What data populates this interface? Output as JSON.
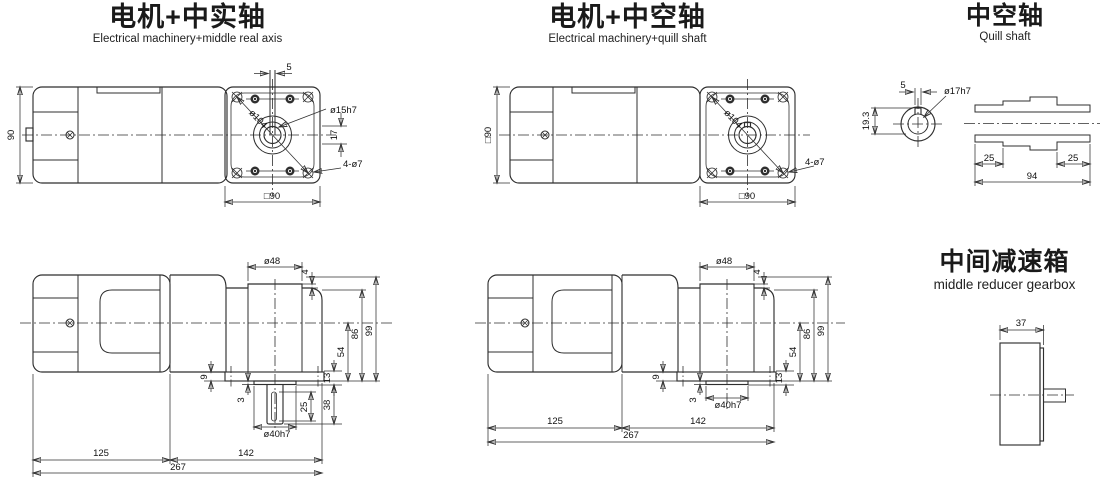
{
  "colors": {
    "line": "#2f2f2f",
    "text": "#111111",
    "background": "#ffffff"
  },
  "titles": {
    "solid": {
      "zh": "电机+中实轴",
      "en": "Electrical machinery+middle real axis"
    },
    "hollow": {
      "zh": "电机+中空轴",
      "en": "Electrical machinery+quill shaft"
    },
    "quill": {
      "zh": "中空轴",
      "en": "Quill shaft"
    },
    "gearbox": {
      "zh": "中间减速箱",
      "en": "middle reducer gearbox"
    }
  },
  "dims": {
    "solid_top": {
      "height": "90",
      "key_width": "5",
      "bolt_circle": "ø104",
      "shaft_dia": "ø15h7",
      "key_span": "17",
      "mount_holes": "4-ø7",
      "face": "□90"
    },
    "hollow_top": {
      "height": "□90",
      "bolt_circle": "ø104",
      "mount_holes": "4-ø7",
      "face": "□90"
    },
    "quill": {
      "key_width": "5",
      "bore_depth": "19.3",
      "bore_dia": "ø17h7",
      "left_len": "25",
      "right_len": "25",
      "total_len": "94"
    },
    "solid_side": {
      "boss_dia": "ø48",
      "boss_h": "4",
      "h99": "99",
      "h86": "86",
      "h54": "54",
      "h13": "13",
      "shaft_len": "38",
      "flange_t": "9",
      "boss_t": "3",
      "key_len": "25",
      "pilot_dia": "ø40h7",
      "motor_len": "125",
      "gear_len": "142",
      "total_len": "267"
    },
    "hollow_side": {
      "boss_dia": "ø48",
      "boss_h": "4",
      "h99": "99",
      "h86": "86",
      "h54": "54",
      "h13": "13",
      "flange_t": "9",
      "boss_t": "3",
      "pilot_dia": "ø40h7",
      "motor_len": "125",
      "gear_len": "142",
      "total_len": "267"
    },
    "gearbox_side": {
      "width": "37"
    }
  }
}
